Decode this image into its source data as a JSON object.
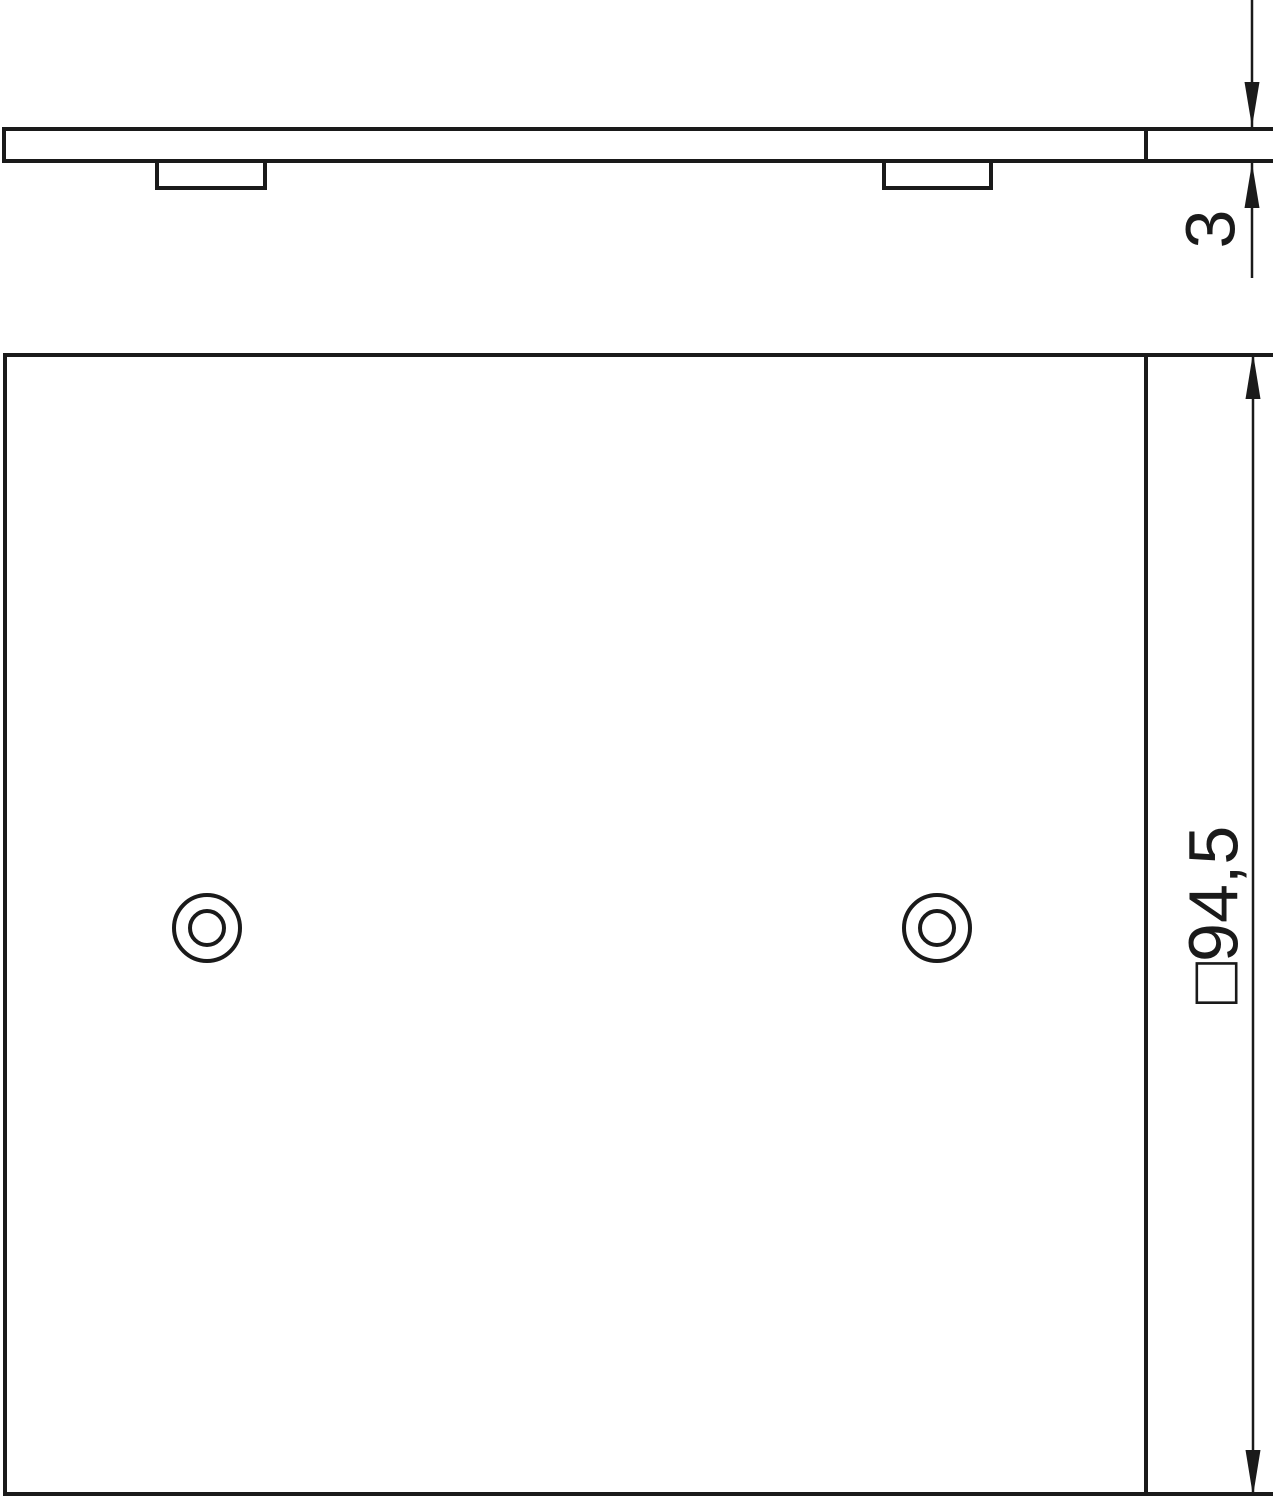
{
  "drawing": {
    "kind": "technical-drawing",
    "background_color": "#ffffff",
    "line_color": "#1a1a1a",
    "views": {
      "side_view": {
        "description": "side profile of cover plate with two mounting bosses"
      },
      "front_view": {
        "description": "square cover plate with two concentric screw holes"
      }
    }
  },
  "dimensions": {
    "thickness": {
      "label": "3",
      "orientation": "vertical-rotated"
    },
    "size": {
      "label": "□94,5",
      "orientation": "vertical-rotated"
    }
  }
}
